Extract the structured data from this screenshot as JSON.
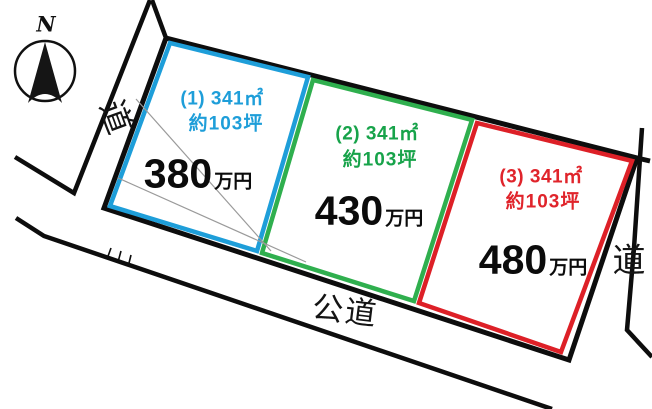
{
  "compass": {
    "north_label": "N"
  },
  "roads": {
    "left_label": "道",
    "right_label": "道",
    "bottom_label": "公道"
  },
  "plots": [
    {
      "id": "1",
      "area_label": "(1) 341㎡",
      "tsubo_label": "約103坪",
      "price_value": "380",
      "price_unit": "万円",
      "border_color": "#1E9ED9",
      "text_color": "#1E9ED9"
    },
    {
      "id": "2",
      "area_label": "(2) 341㎡",
      "tsubo_label": "約103坪",
      "price_value": "430",
      "price_unit": "万円",
      "border_color": "#2FAF4E",
      "text_color": "#17A34A"
    },
    {
      "id": "3",
      "area_label": "(3) 341㎡",
      "tsubo_label": "約103坪",
      "price_value": "480",
      "price_unit": "万円",
      "border_color": "#DD2027",
      "text_color": "#E0242B"
    }
  ],
  "line_colors": {
    "boundary_black": "#0d0d0d",
    "survey_gray": "#9a9a9a"
  }
}
